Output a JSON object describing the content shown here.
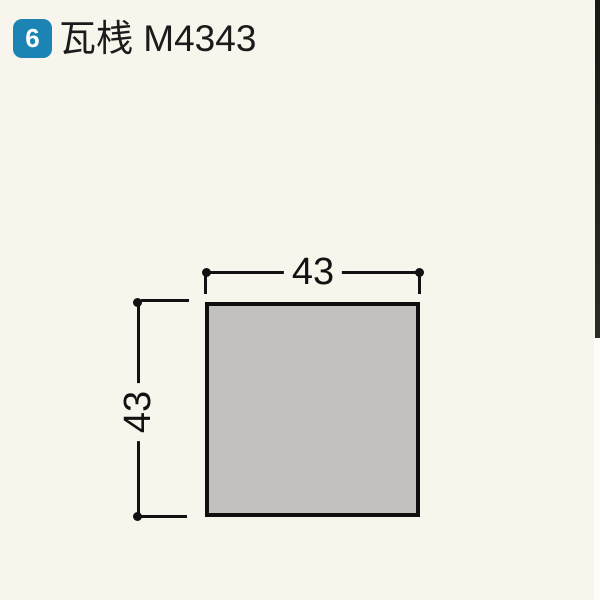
{
  "page": {
    "background_color": "#F8F5EC",
    "kind": "catalog product diagram"
  },
  "header": {
    "badge_number": "6",
    "badge_color": "#1C83B5",
    "title": "瓦桟 M4343"
  },
  "diagram": {
    "shape": "square-cross-section",
    "fill_color": "#C2C1BE",
    "line_color": "#121212",
    "width_label": "43",
    "height_label": "43"
  }
}
